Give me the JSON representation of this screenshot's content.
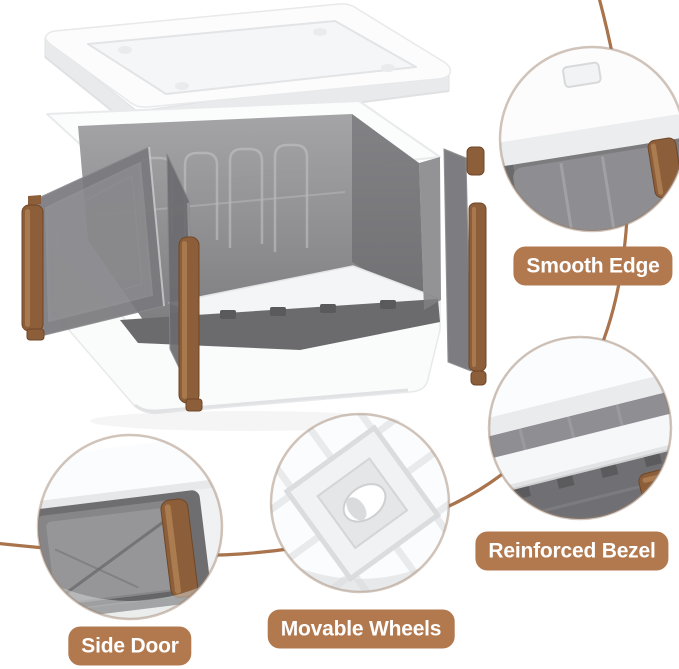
{
  "callouts": {
    "smooth_edge": {
      "label": "Smooth Edge"
    },
    "reinforced_bezel": {
      "label": "Reinforced Bezel"
    },
    "movable_wheels": {
      "label": "Movable Wheels"
    },
    "side_door": {
      "label": "Side Door"
    }
  },
  "colors": {
    "background": "#ffffff",
    "label_background": "#b2794f",
    "label_text": "#ffffff",
    "connector_line": "#a9734c",
    "handle_brown": "#8d5e3a",
    "panel_smoke_gray": "#8a8a8d",
    "plastic_white": "#fbfcfd"
  }
}
